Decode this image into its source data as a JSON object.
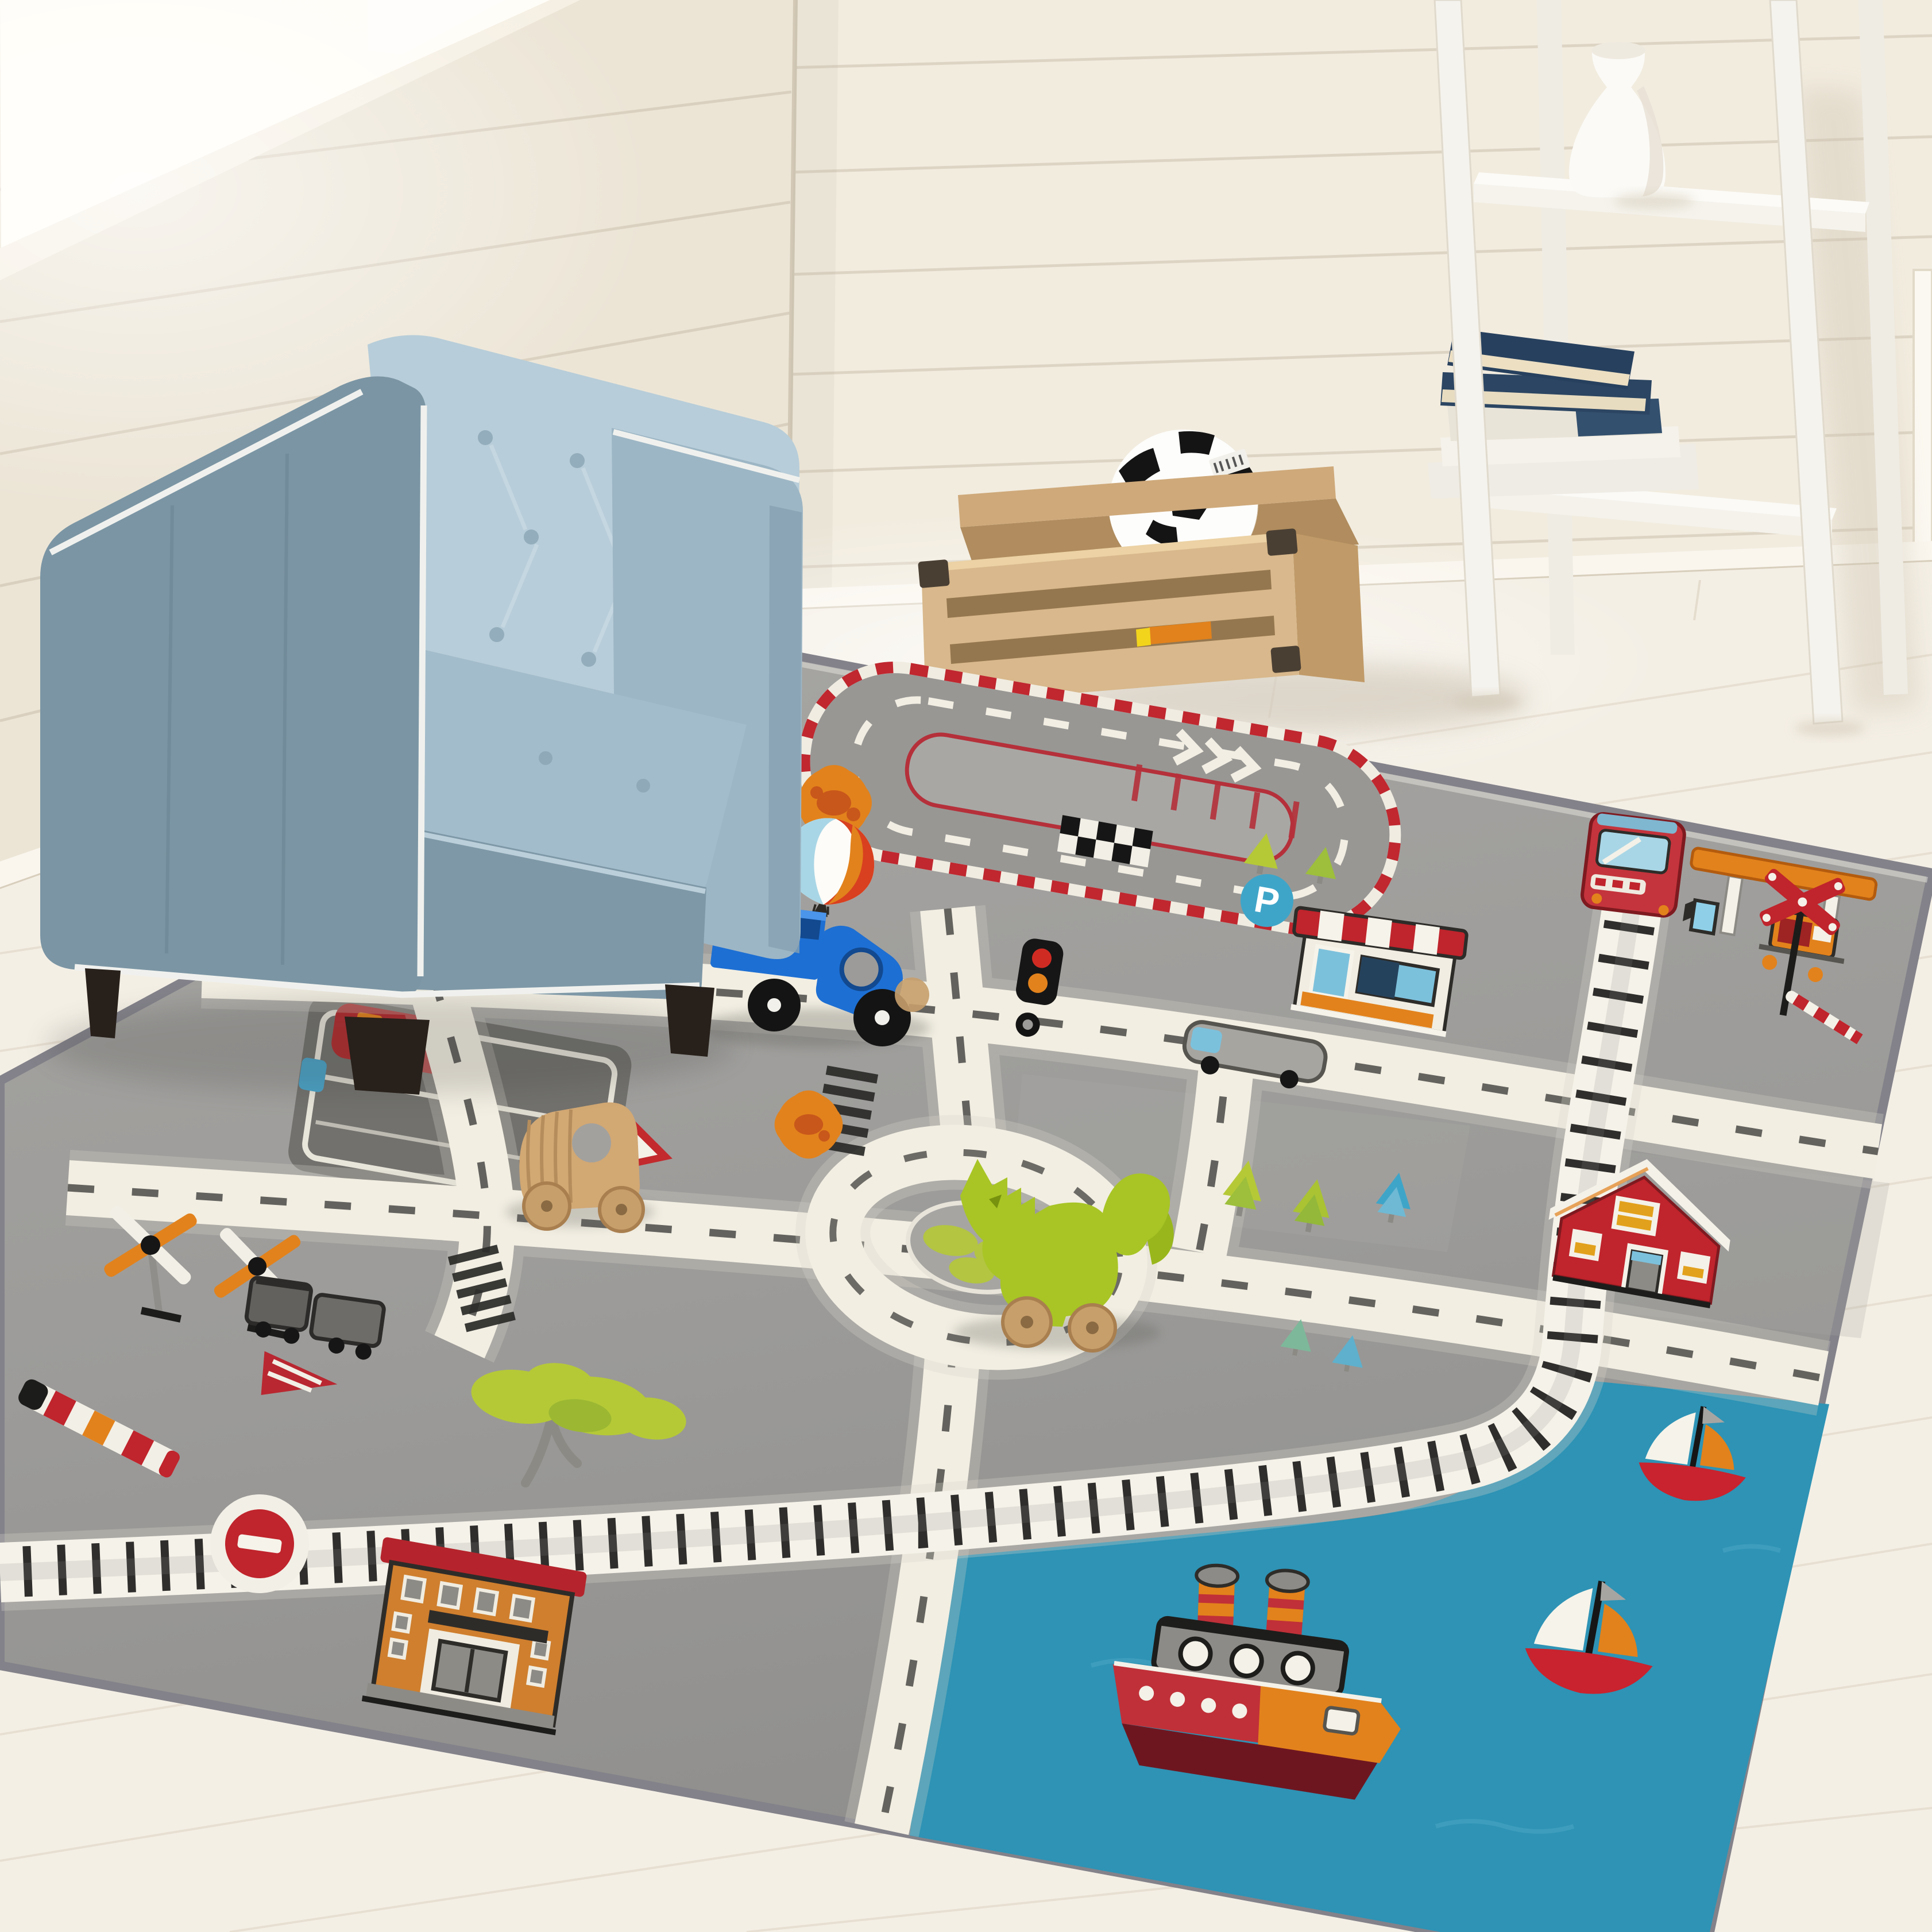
{
  "scene": {
    "description": "Kids playroom corner: white shiplap walls with window light from upper left, whitewashed wood floor, blue tufted child armchair, wooden toy crate with a soccer ball, white ladder shelf holding a white vase and stacked books, and a large gray city-road play rug with toy truck, wooden car and green dinosaur",
    "objects": [
      "armchair",
      "play-rug",
      "toy-crate",
      "soccer-ball",
      "ladder-shelf",
      "vase",
      "book-stack",
      "toy-truck",
      "wooden-toy-car",
      "dino-toy"
    ]
  },
  "labels": {
    "parking_letter": "P"
  },
  "palette": {
    "wall": "#f2ecdf",
    "wall_left": "#ece5d6",
    "window": "#fffdf7",
    "plank": "#d8cfbe",
    "floor": "#f4efe5",
    "floor_line": "#ddd3c2",
    "rug": "#9c9b99",
    "rug_light": "#abaaa7",
    "rug_edge": "#83828a",
    "road": "#f2eee2",
    "dash": "#4b4a47",
    "track": "#f5f2e9",
    "sleeper": "#1d1d1b",
    "water": "#2e93b5",
    "red": "#c02c33",
    "dark_red": "#71161d",
    "orange": "#e2821c",
    "lime": "#b5c937",
    "sky_blue": "#3fa5c8",
    "light_blue": "#a9d6e6",
    "chair": "#7b95a4",
    "chair_light": "#b7cdd9",
    "chair_seat": "#a3bccb",
    "piping": "#f0f1ee",
    "foot": "#28201a",
    "wood": "#d8b88c",
    "wood_dark": "#bd9a6a",
    "toy_wood": "#d2a873",
    "navy": "#2b4562",
    "book_white": "#efece5",
    "white": "#fbfaf6",
    "toy_blue": "#1d6fd3",
    "dino": "#a8c525",
    "gray_car": "#a7a5a0",
    "black": "#161616"
  },
  "rug_motifs": {
    "counts": {
      "orange_flowers": 2,
      "windmills": 2,
      "sailboats": 2,
      "steamboats": 1,
      "zebra_crossings": 2,
      "trees": 8
    },
    "buildings": [
      "striped-awning-shop",
      "gas-station",
      "red-barn-house",
      "brick-building"
    ],
    "signs": [
      "parking",
      "traffic-light",
      "warning-triangle",
      "do-not-enter",
      "railroad-crossing"
    ],
    "features": [
      "race-track",
      "roundabout",
      "train-track",
      "harbor-water",
      "parking-pad"
    ]
  },
  "shelf": {
    "navy_books": 3,
    "white_books": 2,
    "vases": 1
  }
}
